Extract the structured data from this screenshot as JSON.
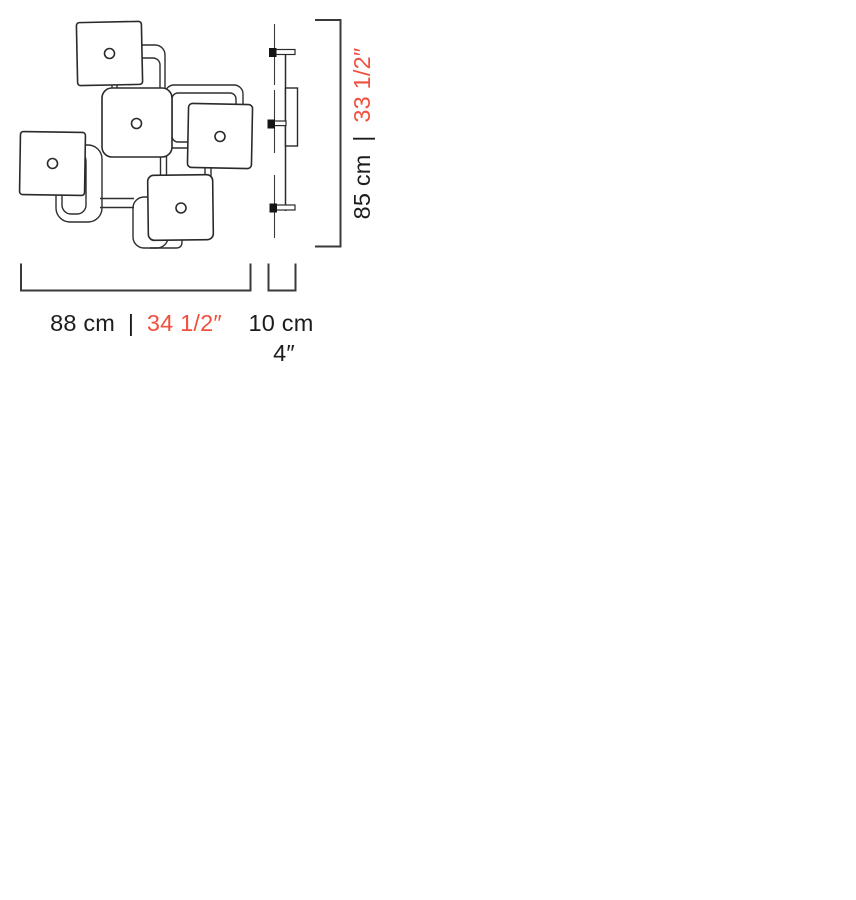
{
  "diagram": {
    "type": "product-dimension-drawing",
    "dimensions": {
      "width": {
        "metric": "88 cm",
        "separator": "|",
        "imperial": "34 1/2″"
      },
      "depth": {
        "metric": "10 cm",
        "imperial": "4″"
      },
      "height": {
        "metric": "85 cm",
        "separator": "|",
        "imperial": "33 1/2″"
      }
    },
    "colors": {
      "imperial_accent": "#F0513E",
      "metric_text": "#1C1C1C",
      "line": "#2E2E2E"
    }
  }
}
